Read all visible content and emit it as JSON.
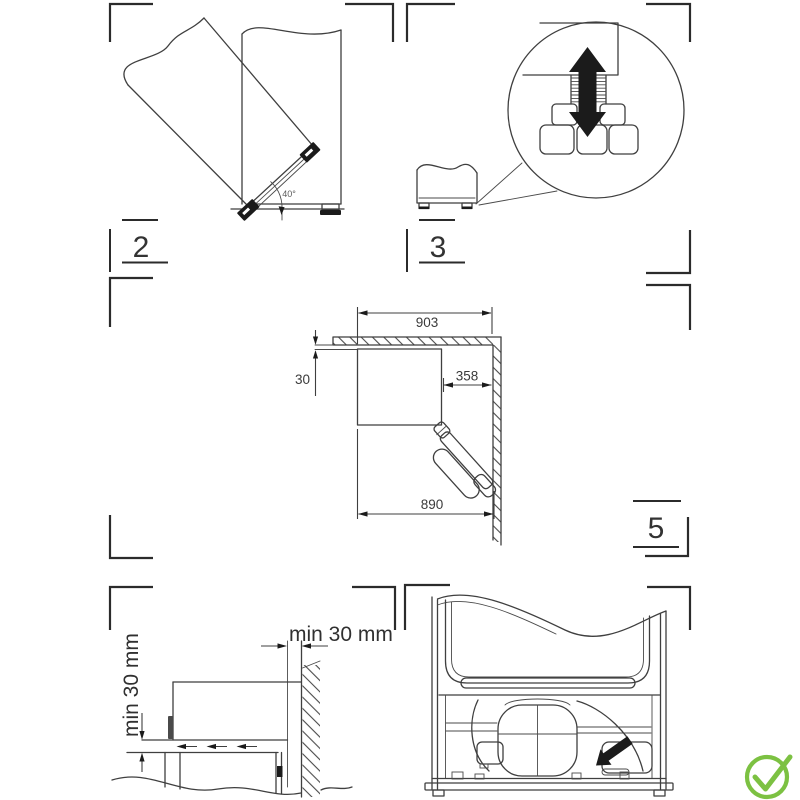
{
  "colors": {
    "line": "#3f3f3f",
    "text": "#3a3a3a",
    "arrow": "#1b1b1b",
    "success": "#7cc142"
  },
  "status_icon": {
    "name": "check-circle-icon",
    "glyph": "✓",
    "color": "#7cc142"
  },
  "panels": {
    "door_tilt": {
      "number": "2",
      "angle_label": "40°"
    },
    "leveling": {
      "number": "3"
    },
    "clearances": {
      "total_width": "903",
      "top_gap": "30",
      "door_swing": "358",
      "depth": "890"
    },
    "ventilation": {
      "rear_label": "min 30 mm",
      "bottom_label": "min 30 mm"
    },
    "rear_view": {
      "number": "5"
    }
  }
}
